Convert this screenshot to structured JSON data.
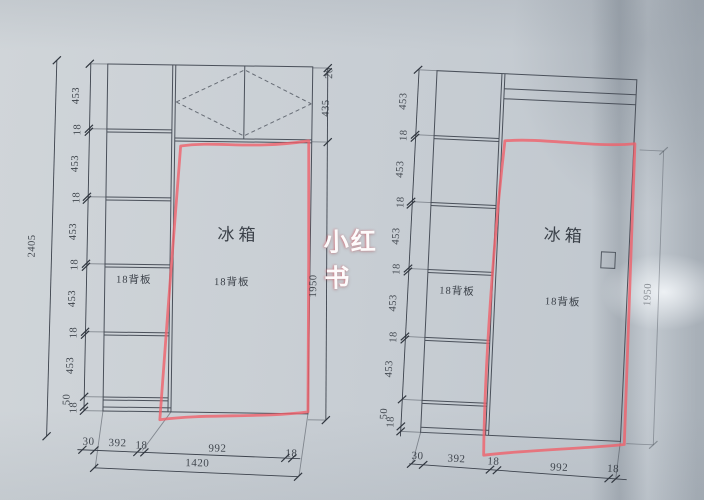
{
  "watermark": "小红书",
  "colors": {
    "paper": "#c7cdd2",
    "cad_line": "#4a505a",
    "red_outline": "#f0606a",
    "text": "#2e343c",
    "watermark_white": "#ffffff"
  },
  "drawings": {
    "left": {
      "overall_height": "2405",
      "height_chain": [
        "453",
        "18",
        "453",
        "18",
        "453",
        "18",
        "453",
        "18",
        "453",
        "50",
        "18"
      ],
      "top_gap": "20",
      "top_section_height": "435",
      "fridge_opening_height": "1950",
      "bottom_chain": [
        "30",
        "392",
        "18",
        "992",
        "18"
      ],
      "bottom_total": "1420",
      "fridge_label": "冰箱",
      "fridge_back_panel_label": "18背板",
      "column_back_panel_label": "18背板"
    },
    "right": {
      "height_chain": [
        "453",
        "18",
        "453",
        "18",
        "453",
        "18",
        "453",
        "18",
        "453",
        "50",
        "18"
      ],
      "fridge_opening_height": "1950",
      "bottom_chain": [
        "30",
        "392",
        "18",
        "992",
        "18"
      ],
      "fridge_label": "冰箱",
      "fridge_back_panel_label": "18背板",
      "column_back_panel_label": "18背板"
    }
  }
}
